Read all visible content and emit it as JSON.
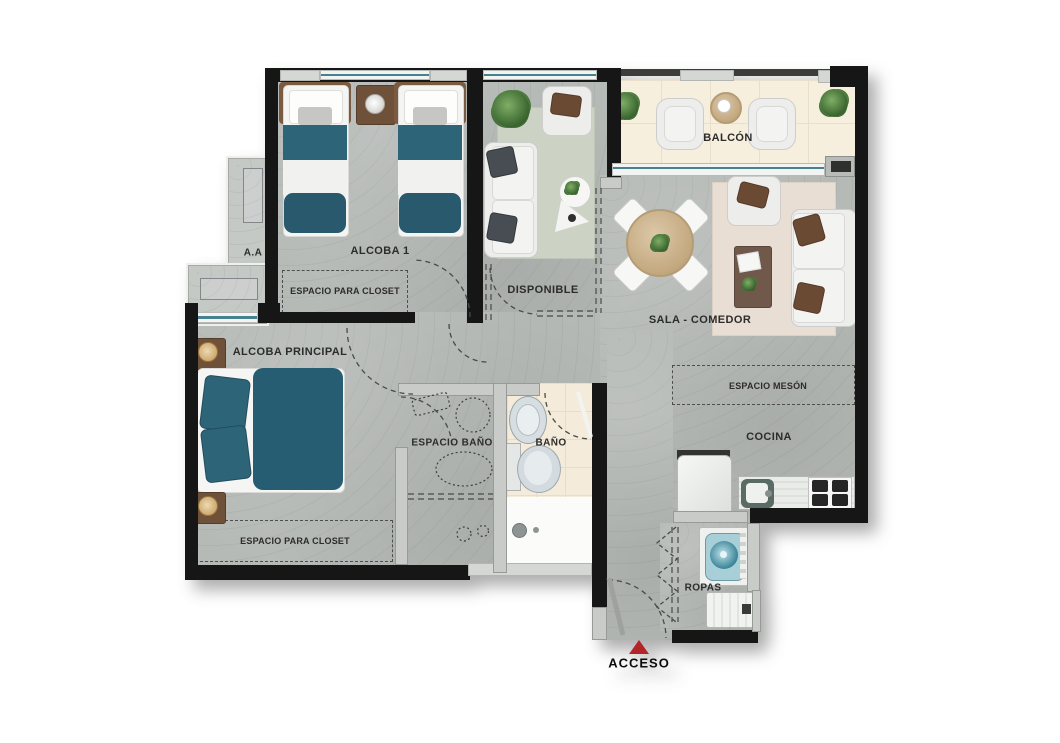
{
  "rooms": {
    "balcon": {
      "label": "BALCÓN"
    },
    "alcoba1": {
      "label": "ALCOBA 1"
    },
    "disponible": {
      "label": "DISPONIBLE"
    },
    "sala": {
      "label": "SALA - COMEDOR"
    },
    "cocina": {
      "label": "COCINA"
    },
    "alcoba_principal": {
      "label": "ALCOBA PRINCIPAL"
    },
    "espacio_banio": {
      "label": "ESPACIO BAÑO"
    },
    "banio": {
      "label": "BAÑO"
    },
    "ropas": {
      "label": "ROPAS"
    },
    "aa": {
      "label": "A.A"
    }
  },
  "annotations": {
    "closet_alcoba1": "ESPACIO PARA CLOSET",
    "closet_principal": "ESPACIO PARA CLOSET",
    "meson": "ESPACIO MESÓN",
    "acceso": "ACCESO"
  },
  "colors": {
    "wall": "#161616",
    "floor_concrete": "#b6bab7",
    "floor_balcony": "#f7efdd",
    "floor_bath": "#f4ebda",
    "accent_teal": "#2e6478",
    "rug_sage": "#ccd3c5",
    "rug_cream": "#e9ded3",
    "wood": "#c8a87e",
    "pillow_brown": "#6b4a33",
    "access_red": "#b2262b"
  }
}
